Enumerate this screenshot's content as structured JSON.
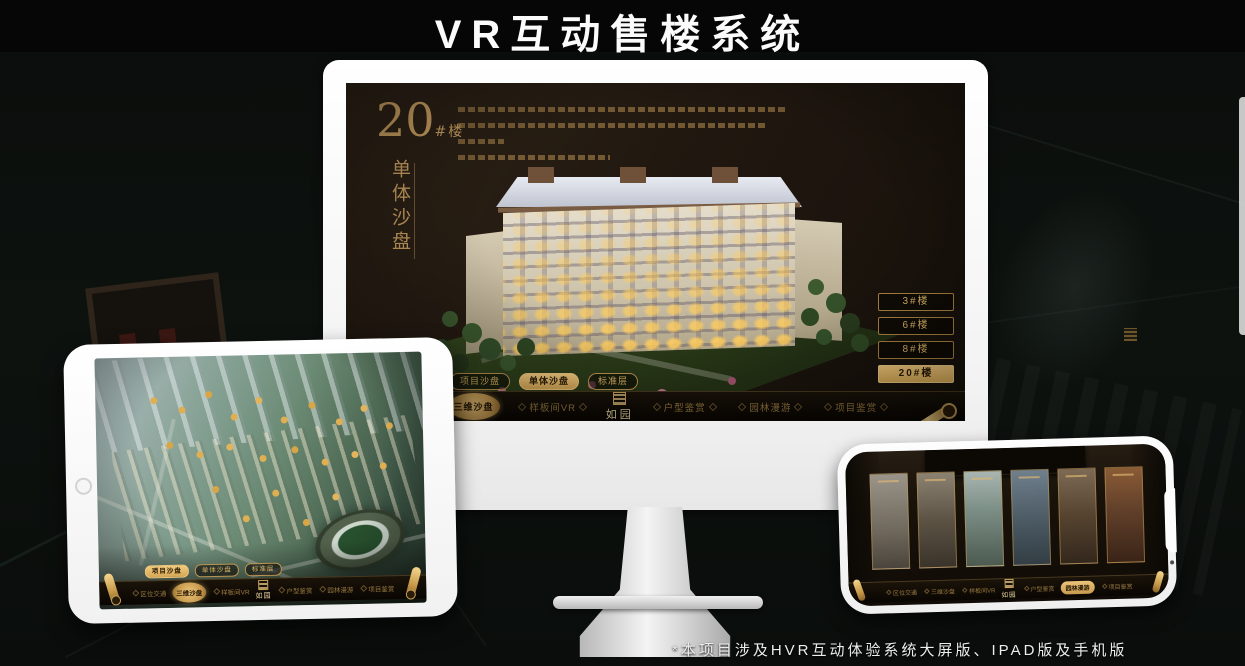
{
  "header": {
    "title": "VR互动售楼系统"
  },
  "footer": {
    "note": "*本项目涉及HVR互动体验系统大屏版、IPAD版及手机版"
  },
  "brand": {
    "logo": "如园"
  },
  "nav": {
    "items": [
      "区位交通",
      "三维沙盘",
      "样板间VR",
      "户型鉴赏",
      "园林漫游",
      "项目鉴赏"
    ]
  },
  "sub_tabs": [
    "项目沙盘",
    "单体沙盘",
    "标准层"
  ],
  "monitor": {
    "building_number": "20",
    "building_unit": "#楼",
    "section_title": "单体沙盘",
    "floor_buttons": [
      "3#楼",
      "6#楼",
      "8#楼",
      "20#楼"
    ],
    "active_floor": "20#楼"
  },
  "colors": {
    "gold": "#cfa162",
    "gold_active": "#e9c171",
    "screen_bg": "#211810"
  }
}
